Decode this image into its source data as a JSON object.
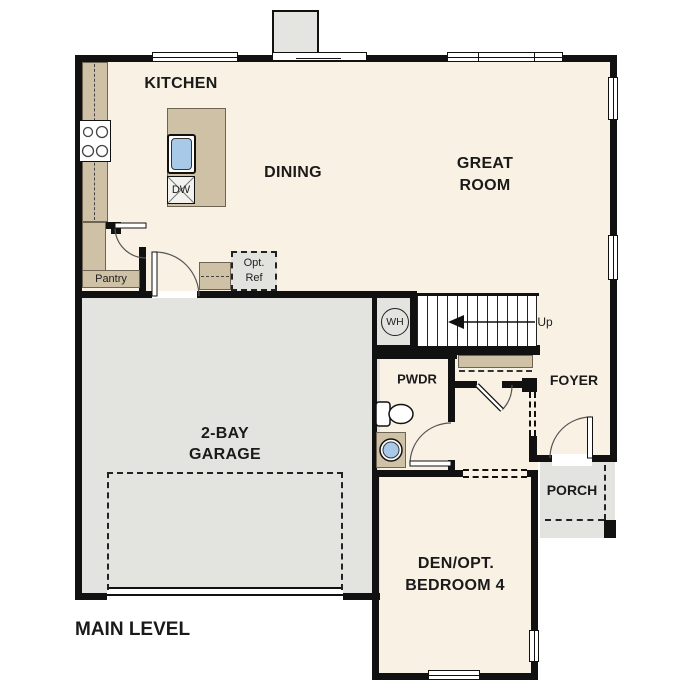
{
  "plan": {
    "title": "MAIN LEVEL",
    "rooms": {
      "kitchen": {
        "label": "KITCHEN"
      },
      "dining": {
        "label": "DINING"
      },
      "great_room": {
        "line1": "GREAT",
        "line2": "ROOM"
      },
      "pantry": {
        "label": "Pantry"
      },
      "garage": {
        "line1": "2-BAY",
        "line2": "GARAGE"
      },
      "powder": {
        "label": "PWDR"
      },
      "foyer": {
        "label": "FOYER"
      },
      "porch": {
        "label": "PORCH"
      },
      "den": {
        "line1": "DEN/OPT.",
        "line2": "BEDROOM 4"
      }
    },
    "fixtures": {
      "dishwasher_label": "DW",
      "water_heater_label": "WH",
      "opt_ref_line1": "Opt.",
      "opt_ref_line2": "Ref",
      "stairs_direction_label": "Up"
    },
    "colors": {
      "floor": "#f9f1e3",
      "garage_floor": "#e3e3e0",
      "cabinet_tan": "#cfc1a5",
      "wall": "#111111",
      "fixture_water_blue": "#a9c9e9",
      "optional_item_fill": "#e2e2df"
    }
  }
}
